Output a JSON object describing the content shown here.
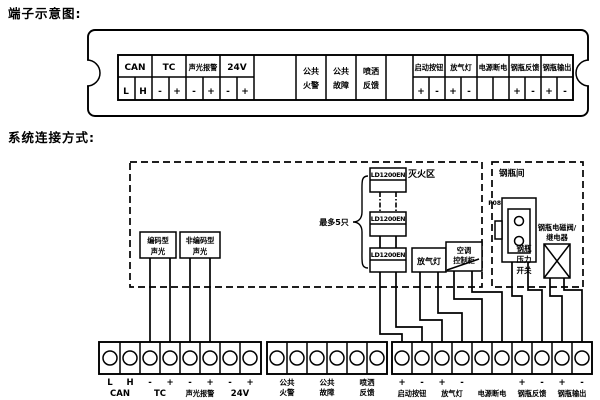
{
  "headings": {
    "terminal_diagram": "端子示意图:",
    "system_connection": "系统连接方式:"
  },
  "terminal_strip": {
    "can": {
      "label": "CAN",
      "cells": [
        "L",
        "H"
      ]
    },
    "tc": {
      "label": "TC",
      "cells": [
        "-",
        "+"
      ]
    },
    "sound_light": {
      "label": "声光报警",
      "cells": [
        "-",
        "+"
      ]
    },
    "v24": {
      "label": "24V",
      "cells": [
        "-",
        "+"
      ]
    },
    "common_fire": {
      "lines": [
        "公共",
        "火警"
      ]
    },
    "common_fault": {
      "lines": [
        "公共",
        "故障"
      ]
    },
    "spray_feedback": {
      "lines": [
        "喷洒",
        "反馈"
      ]
    },
    "start_button": {
      "label": "启动按钮",
      "cells": [
        "+",
        "-"
      ]
    },
    "gas_lamp": {
      "label": "放气灯",
      "cells": [
        "+",
        "-"
      ]
    },
    "power_off": {
      "label": "电源断电",
      "cells": [
        "",
        ""
      ]
    },
    "cyl_feedback": {
      "label": "钢瓶反馈",
      "cells": [
        "+",
        "-"
      ]
    },
    "cyl_output": {
      "label": "钢瓶输出",
      "cells": [
        "+",
        "-"
      ]
    }
  },
  "diagram": {
    "zone_label": "灭火区",
    "room_label": "钢瓶间",
    "max_units": "最多5只",
    "module": "LD1200EN",
    "coded_sounder": {
      "lines": [
        "编码型",
        "声光"
      ]
    },
    "noncoded_sounder": {
      "lines": [
        "非编码型",
        "声光"
      ]
    },
    "gas_lamp": "放气灯",
    "ac_cabinet": {
      "lines": [
        "空调",
        "控制柜"
      ]
    },
    "pressure_switch": {
      "tag": "P08",
      "lines": [
        "钢瓶",
        "压力",
        "开关"
      ]
    },
    "solenoid": {
      "lines": [
        "钢瓶电磁阀/",
        "继电器"
      ]
    }
  },
  "blocks": {
    "left": {
      "pins": [
        "L",
        "H",
        "-",
        "+",
        "-",
        "+",
        "-",
        "+"
      ],
      "groups": [
        "CAN",
        "TC",
        "声光报警",
        "24V"
      ]
    },
    "middle": {
      "groups": [
        {
          "lines": [
            "公共",
            "火警"
          ]
        },
        {
          "lines": [
            "公共",
            "故障"
          ]
        },
        {
          "lines": [
            "喷洒",
            "反馈"
          ]
        }
      ]
    },
    "right": {
      "pins": [
        "+",
        "-",
        "+",
        "-",
        "+",
        "-",
        "+",
        "-"
      ],
      "groups": [
        "启动按钮",
        "放气灯",
        "电源断电",
        "钢瓶反馈",
        "钢瓶输出"
      ]
    }
  }
}
